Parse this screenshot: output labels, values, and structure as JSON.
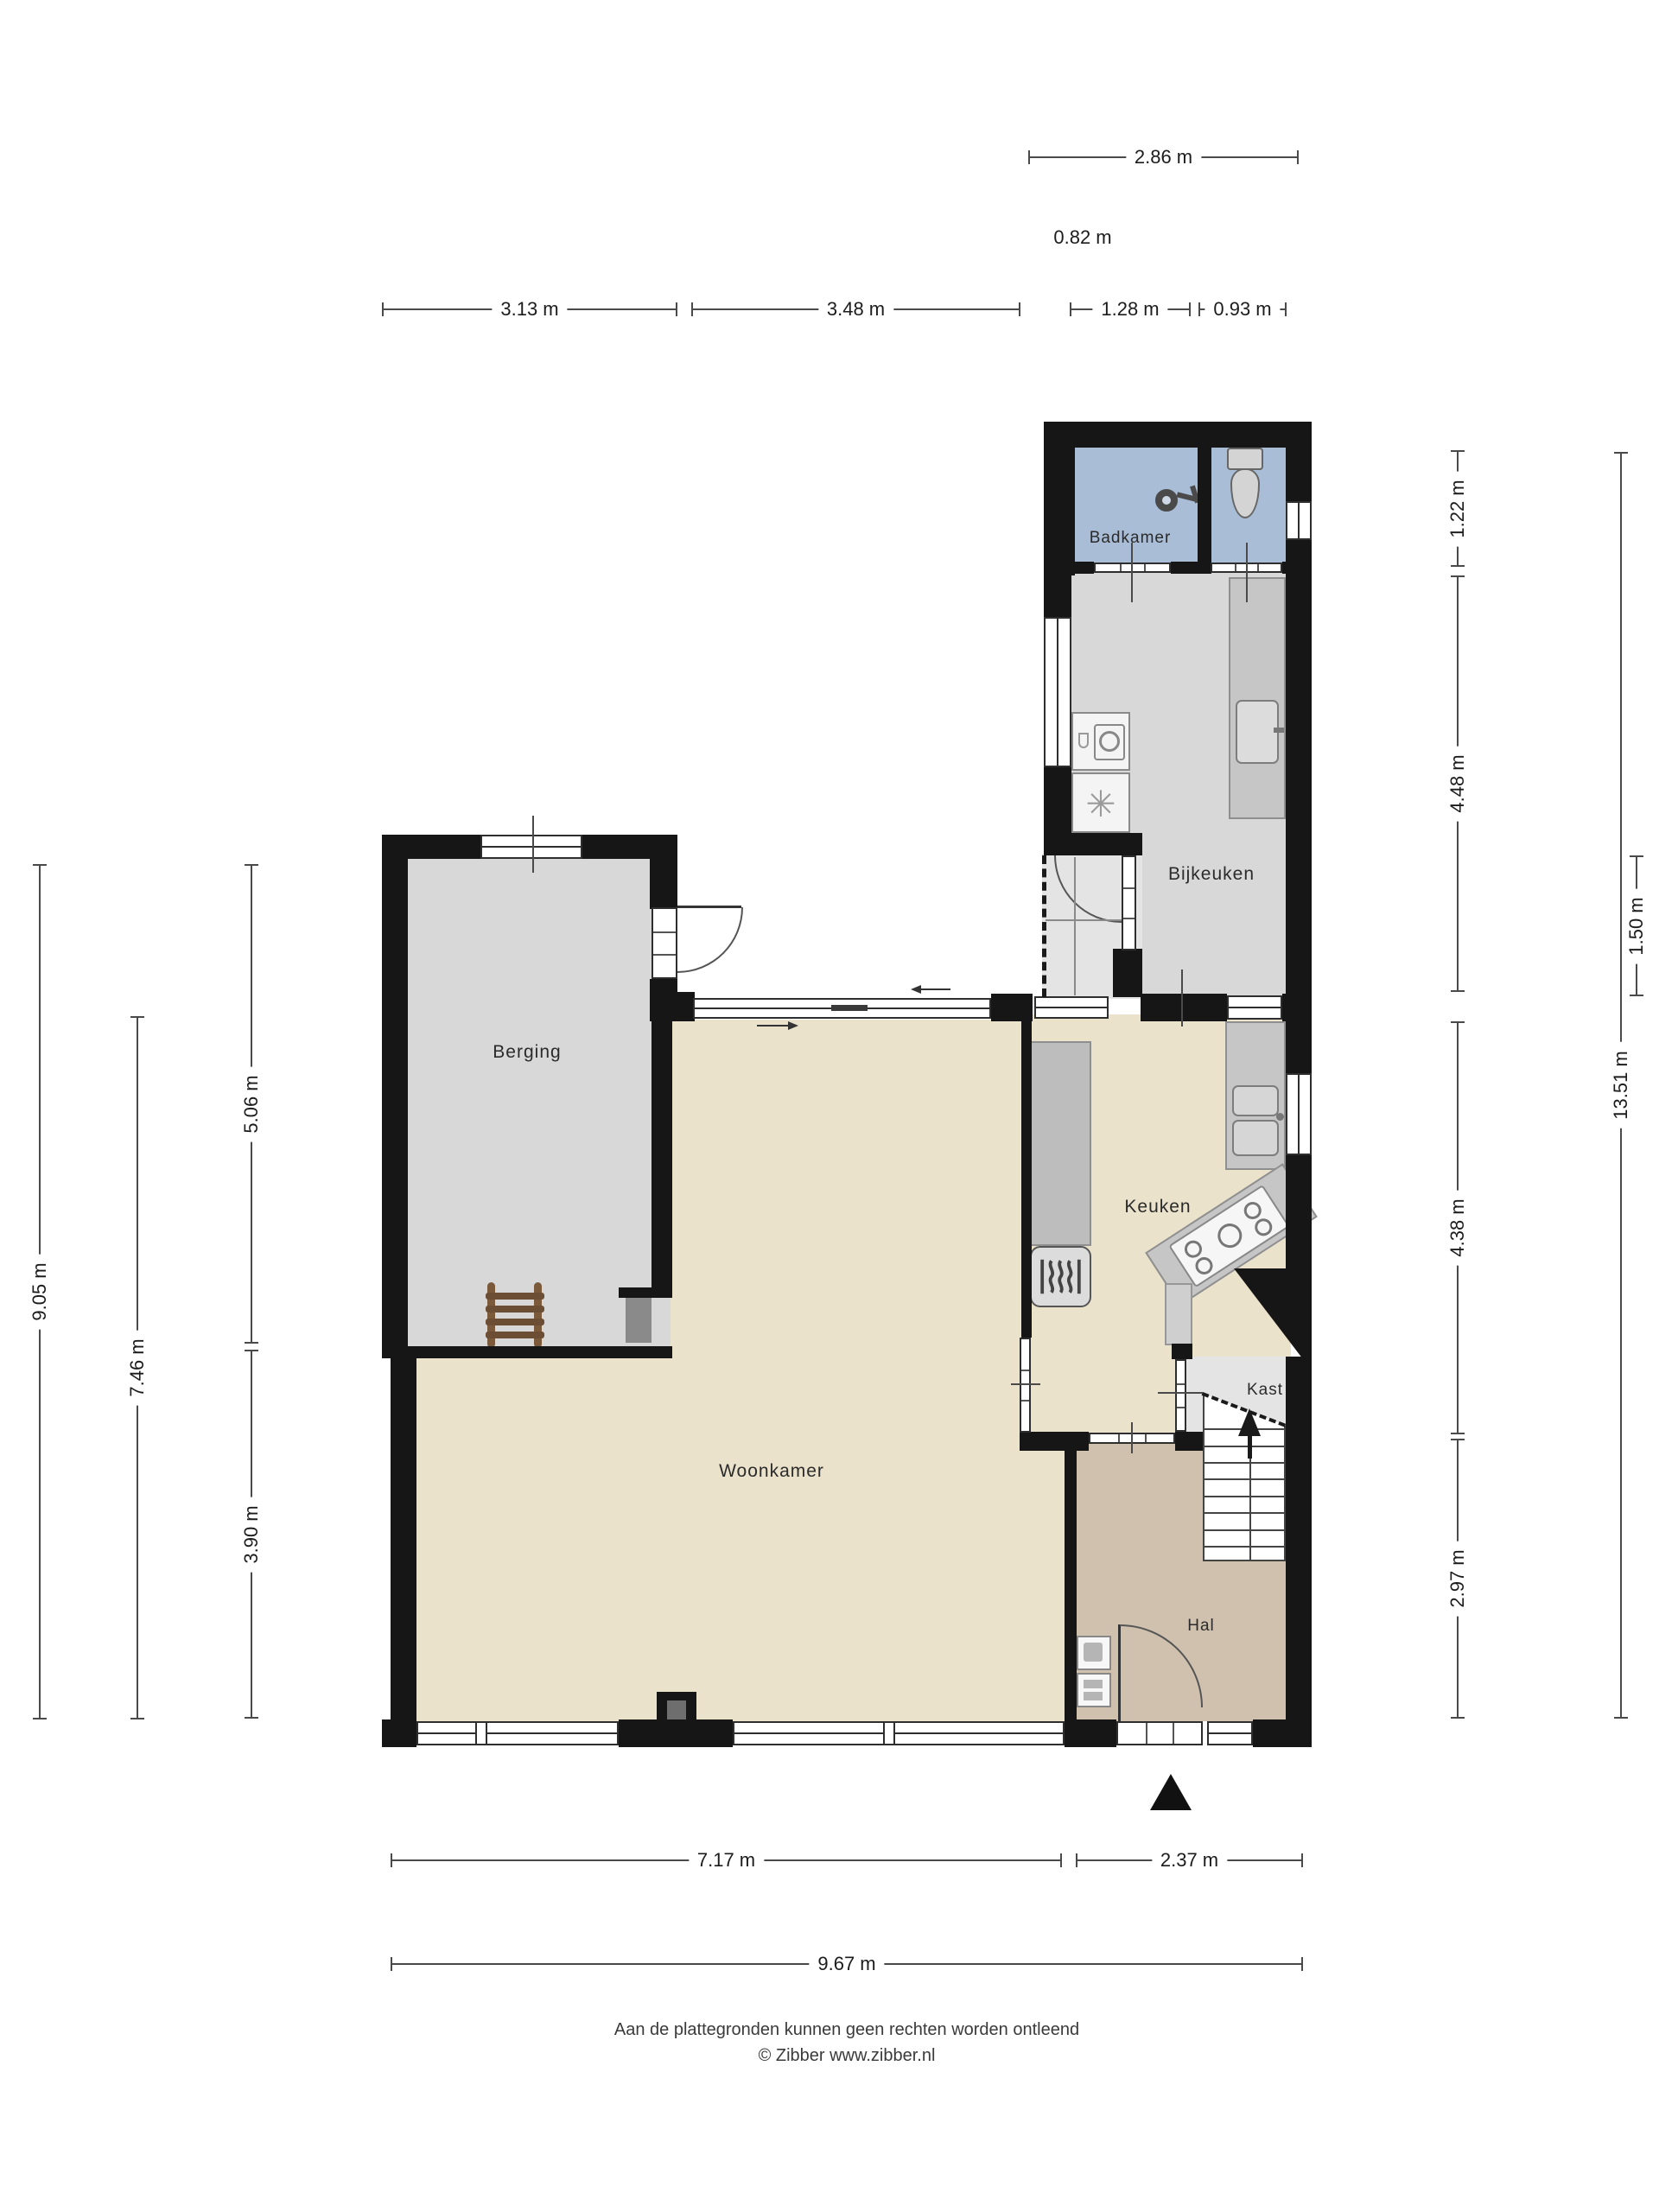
{
  "title": "Plattegrond begane grond",
  "rooms": {
    "badkamer": "Badkamer",
    "bijkeuken": "Bijkeuken",
    "berging": "Berging",
    "keuken": "Keuken",
    "woonkamer": "Woonkamer",
    "kast": "Kast",
    "hal": "Hal"
  },
  "dimensions": {
    "t1": "2.86 m",
    "t2": "0.82 m",
    "a1": "3.13 m",
    "a2": "3.48 m",
    "a3": "1.28 m",
    "a4": "0.93 m",
    "l1": "9.05 m",
    "l2": "7.46 m",
    "l3": "5.06 m",
    "l4": "3.90 m",
    "r1": "1.22 m",
    "r2": "4.48 m",
    "r3": "4.38 m",
    "r4": "2.97 m",
    "r5": "13.51 m",
    "r6": "1.50 m",
    "b1": "7.17 m",
    "b2": "2.37 m",
    "b3": "9.67 m"
  },
  "icons": {
    "dryer_glyph": "✳"
  },
  "footer": {
    "disclaimer": "Aan de plattegronden kunnen geen rechten worden ontleend",
    "copyright": "© Zibber www.zibber.nl"
  },
  "colors": {
    "page": "#ffffff",
    "wall": "#161616",
    "bath": "#a9bdd6",
    "utility": "#d8d8d8",
    "closet": "#e4e4e4",
    "living": "#eae2cb",
    "hall": "#cfc1ae",
    "counter": "#c6c6c6",
    "mat": "#8a8a8a",
    "ladder": "#7b5a3c",
    "dim": "#4a4a4a"
  }
}
